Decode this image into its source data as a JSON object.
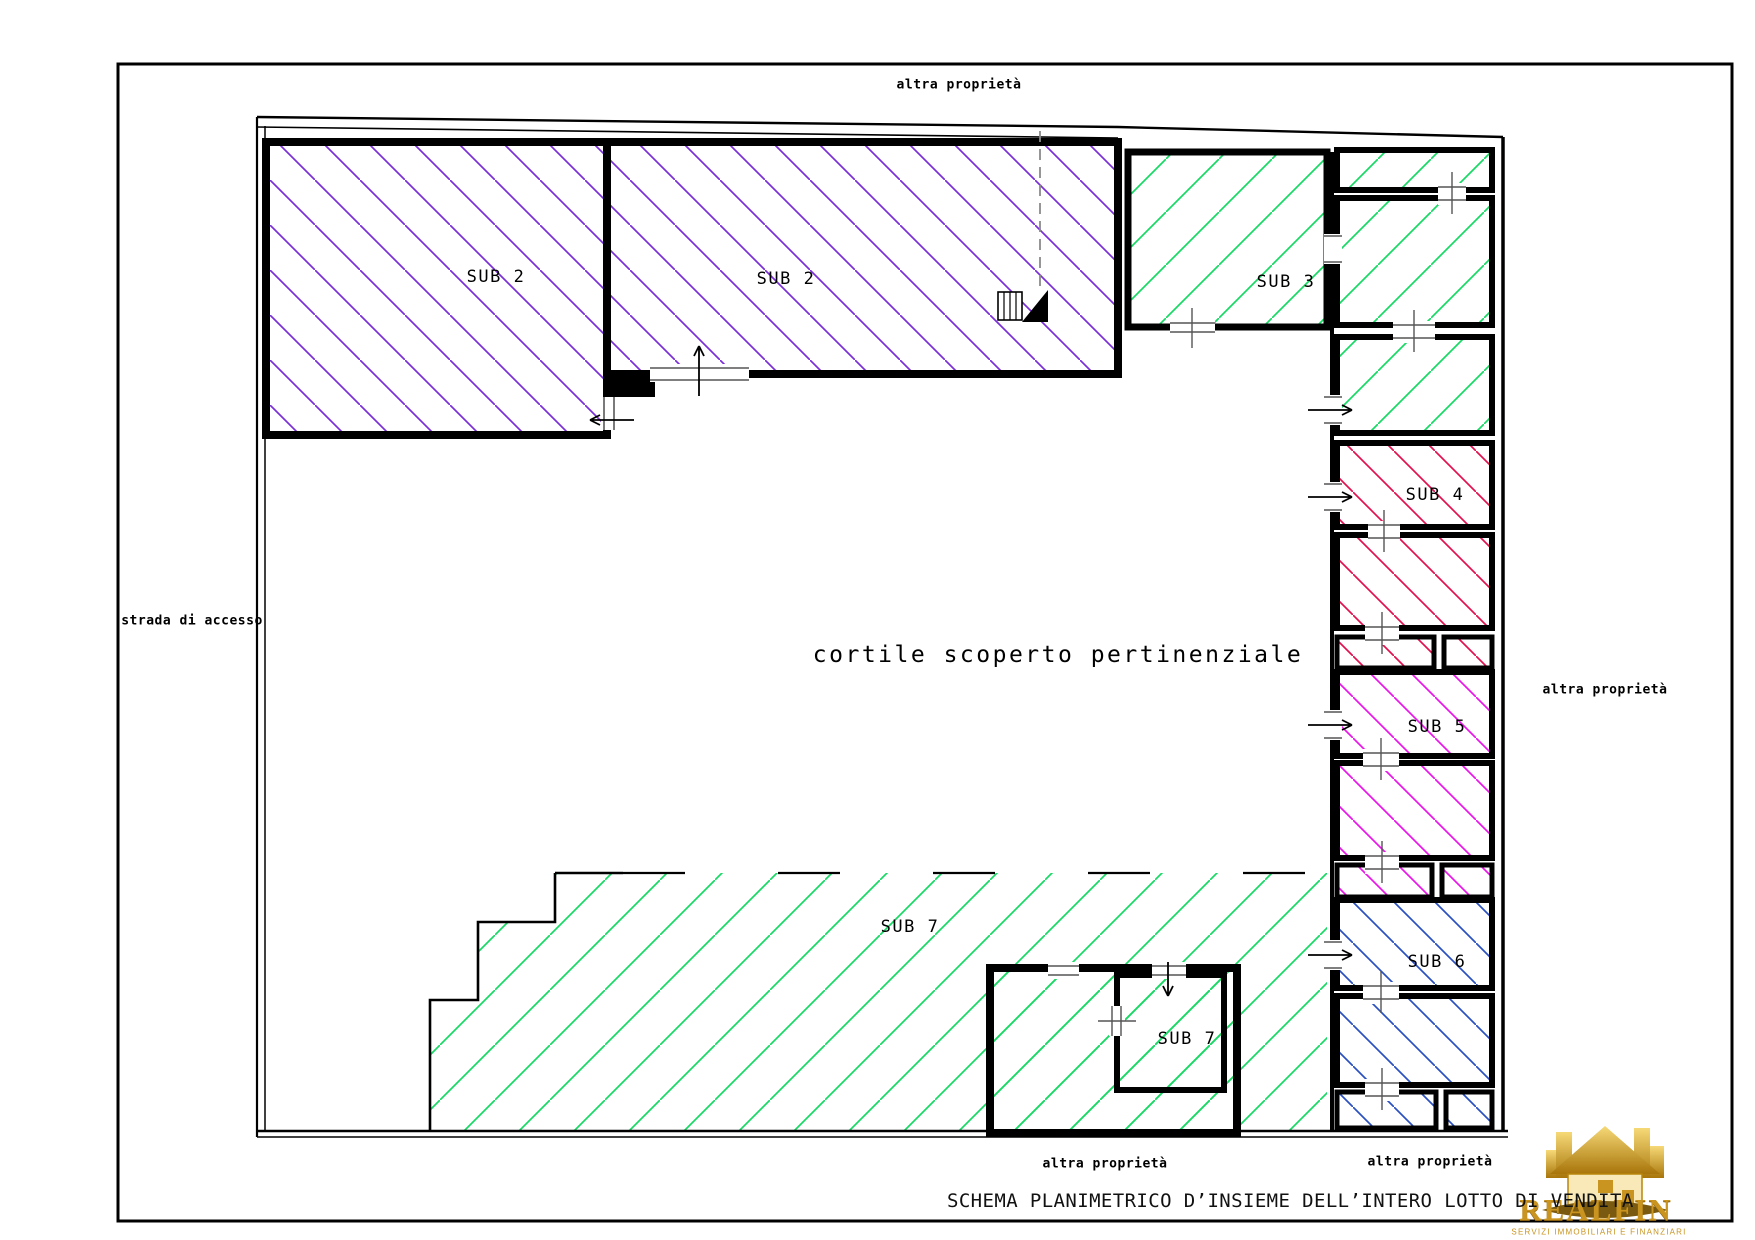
{
  "drawing": {
    "title": "SCHEMA PLANIMETRICO D’INSIEME DELL’INTERO LOTTO DI VENDITA",
    "boundary_labels": {
      "top": "altra proprietà",
      "left": "strada di accesso",
      "right": "altra proprietà",
      "bottom_center": "altra proprietà",
      "bottom_right": "altra proprietà"
    },
    "courtyard_label": "cortile scoperto pertinenziale",
    "rooms": {
      "sub2_left": "SUB 2",
      "sub2_right": "SUB 2",
      "sub3": "SUB 3",
      "sub4": "SUB 4",
      "sub5": "SUB 5",
      "sub6": "SUB 6",
      "sub7_main": "SUB 7",
      "sub7_annex": "SUB 7"
    },
    "hatch_colors": {
      "sub2": "#7b2fd6",
      "sub3": "#17d964",
      "sub4": "#e01250",
      "sub5": "#e816e8",
      "sub6": "#2b50c0",
      "sub7": "#17d964"
    },
    "line_color": "#000000",
    "construction_line_color": "#8a8a8a"
  },
  "logo": {
    "name": "REALFIN",
    "tagline": "SERVIZI IMMOBILIARI E FINANZIARI",
    "gold": "#c9941f"
  }
}
